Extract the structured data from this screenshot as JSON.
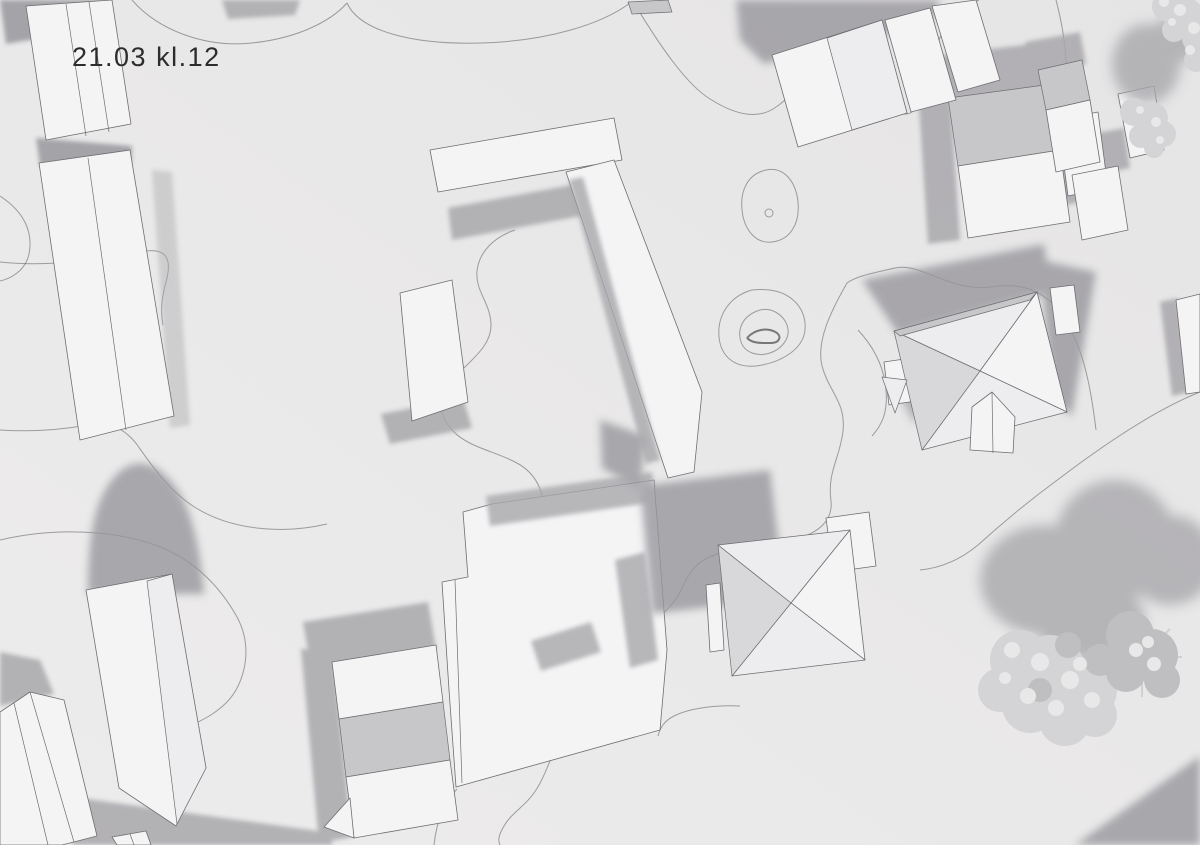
{
  "annotation": {
    "label": "21.03 kl.12"
  },
  "palette": {
    "background_dark": "#e6e5e6",
    "background_light": "#edecec",
    "building_white": "#f4f4f5",
    "building_light": "#ededef",
    "roof_gray": "#c7c7c9",
    "roof_mid": "#d8d8da",
    "shadow": "#a8a7ab",
    "shadow_dark": "#98979c",
    "edge_line": "#6e6e72",
    "contour_line": "#5a5a5e",
    "tree_crown": "#d4d3d5",
    "tree_crown_light": "#e9e8e9",
    "tree_crown_dark": "#bfbec1",
    "text": "#2c2c2e"
  }
}
